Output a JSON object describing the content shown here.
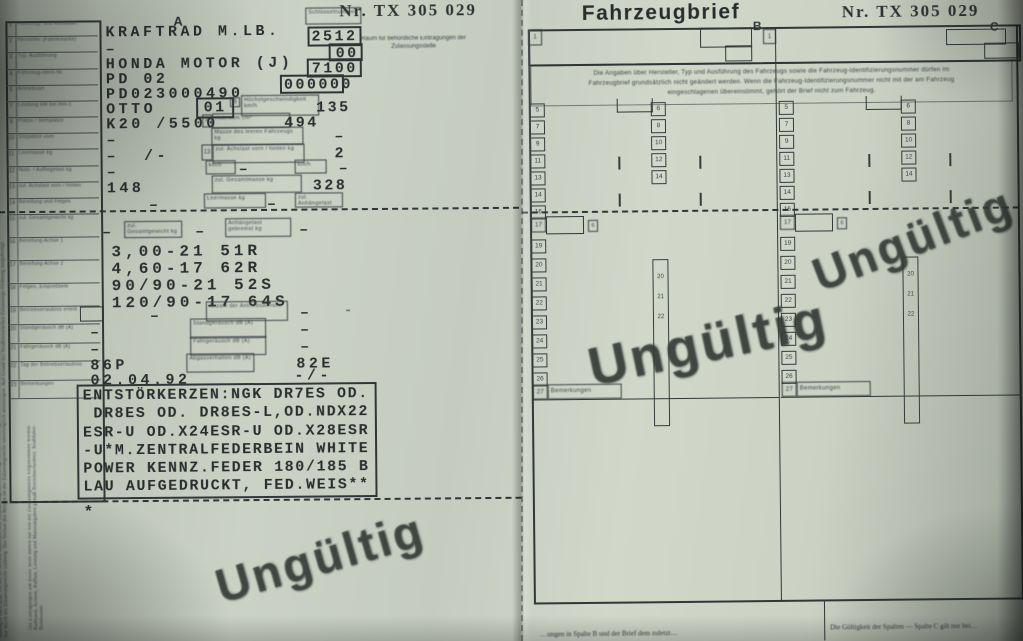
{
  "doc": {
    "serial": "Nr. TX 305 029",
    "stamp": "Ungültig"
  },
  "colors": {
    "paper": "#cbd2c5",
    "ink": "#2b2f30",
    "stamp_ink": "#363c38"
  },
  "left_page": {
    "section_label": "A",
    "header_note": "Raum für behördliche Eintragungen der Zulassungsstelle",
    "key_numbers": {
      "type": "2512",
      "check": "00",
      "manufacturer": "7100",
      "variant": "000000",
      "engine": "01",
      "engine_sup": "6",
      "cell8": "8",
      "cell13": "13",
      "cell9": "9"
    },
    "values": {
      "vehicle_kind": "KRAFTRAD M.LB.",
      "dash_a": "–",
      "manufacturer": "HONDA MOTOR (J)",
      "type": "PD 02",
      "vin": "PD023000490",
      "engine_type": "OTTO",
      "power_rpm": "K20 /5500",
      "dash_b": "–",
      "dash_c": "–  /-",
      "dash_d": "–",
      "curb_mass": "148"
    },
    "right_values": {
      "top_speed": "135",
      "displacement": "494",
      "dash_a": "–",
      "axles": "2",
      "dash_b": "–",
      "dash_c": "–",
      "total_mass": "328",
      "dash_d": "–",
      "dash_e": "–"
    },
    "row_above_tires": {
      "dash_l": "–",
      "dash_m": "–",
      "dash_r": "–"
    },
    "tires": [
      "3,00-21 51R",
      "4,60-17 62R",
      "90/90-21 52S",
      "120/90-17 64S"
    ],
    "lower_rows": {
      "dash1_l": "–",
      "dash1_r": "–",
      "tail_dash": "-",
      "dash2_l": "–",
      "dash2_r": "–",
      "dash3_l": "–",
      "dash3_r": "–",
      "stand_noise": "86P",
      "drive_noise": "82E",
      "date": "02.04.92",
      "date_right": "-/-"
    },
    "remarks_lines": [
      "ENTSTÖRKERZEN:NGK DR7ES OD.",
      " DR8ES OD. DR8ES-L,OD.NDX22",
      "ESR-U OD.X24ESR-U OD.X28ESR",
      "-U*M.ZENTRALFEDERBEIN WHITE",
      "POWER KENNZ.FEDER 180/185 B",
      "LAU AUFGEDRUCKT, FED.WEIS**"
    ],
    "footnote_star": "*",
    "micro_labels": [
      "Schlüsselnummer",
      "Höchstgeschwindigkeit km/h",
      "Hubraum cm³",
      "Masse des leeren Fahrzeugs kg",
      "zul. Achslast vorn / hinten kg",
      "km/h",
      "km/h",
      "zul. Gesamtmasse kg",
      "Leermasse kg",
      "zul. Anhängelast kg",
      "zul. Gesamtgewicht kg",
      "Anhängelast gebremst kg",
      "Anzahl der Antriebsachsen",
      "Standgeräusch dB (A)",
      "Fahrgeräusch dB (A)",
      "Abgasverhalten dB (A)"
    ],
    "label_rows_top": [
      {
        "n": "1",
        "t": "Fahrzeug- und Aufbauart"
      },
      {
        "n": "2",
        "t": "Hersteller (Fabrikmarke)"
      },
      {
        "n": "3",
        "t": "Typ, Ausführung"
      },
      {
        "n": "4",
        "t": "Fahrzeug-Ident-Nr."
      },
      {
        "n": "5",
        "t": "Antriebsart"
      },
      {
        "n": "7",
        "t": "Leistung kW bei min-1"
      },
      {
        "n": "9",
        "t": "Plätze / Stehplätze"
      },
      {
        "n": "10",
        "t": "Sitzplätze vorn"
      },
      {
        "n": "11",
        "t": "Leermasse kg"
      },
      {
        "n": "12",
        "t": "Nutz- / Aufliegelast kg"
      },
      {
        "n": "13",
        "t": "zul. Achslast vorn / hinten"
      },
      {
        "n": "14",
        "t": "Bereifung und Felgen"
      }
    ],
    "label_rows_mid": [
      {
        "n": "15",
        "t": "zul. Gesamtgewicht kg"
      },
      {
        "n": "16",
        "t": "Bereifung Achse 1"
      },
      {
        "n": "17",
        "t": "Bereifung Achse 2"
      },
      {
        "n": "18",
        "t": "Felgen, Einpreßtiefe"
      }
    ],
    "label_rows_low": [
      {
        "n": "19",
        "t": "Betriebserlaubnis erteilt"
      },
      {
        "n": "20",
        "t": "Standgeräusch dB (A)"
      },
      {
        "n": "21",
        "t": "Fahrgeräusch dB (A)"
      },
      {
        "n": "22",
        "t": "Tag der Betriebserlaubnis"
      },
      {
        "n": "23",
        "t": "Bemerkungen"
      }
    ],
    "margin_text": "Auflagen nach §§ 19, 20, 21 StVZO beachten. Bei Veräußerung des Fahrzeugs ist der Fahrzeugbrief dem Erwerber auszuhändigen. Änderungen der eingetragenen Angaben sind nur durch die Zulassungsstelle zulässig. Der Verlust des Briefes ist der Zulassungsstelle unverzüglich anzuzeigen. Auf Grund der Straßenverkehrs-Zulassungs-Ordnung ausgefertigt.",
    "margin_text2": "Die Eintragungen auf dieser Seite dürfen nur von der Zulassungsstelle vorgenommen werden. Radstand, Achsen, Aufbau, Leistung und Masseangaben gemäß Betriebserlaubnis. Kraftfahrt-Bundesamt."
  },
  "right_page": {
    "title": "Fahrzeugbrief",
    "section_b": "B",
    "section_c": "C",
    "row_number_1": "1",
    "intro_lines": [
      "Die Angaben über Hersteller, Typ und Ausführung des Fahrzeugs sowie die Fahrzeug-Identifizierungsnummer dürfen im",
      "Fahrzeugbrief grundsätzlich nicht geändert werden. Wenn die Fahrzeug-Identifizierungsnummer nicht mit der am Fahrzeug",
      "eingeschlagenen übereinstimmt, gehört der Brief nicht zum Fahrzeug."
    ],
    "col_top_nums": [
      "5",
      "7",
      "9",
      "11",
      "13",
      "14",
      "16"
    ],
    "col_mid_nums": [
      "6",
      "8",
      "10",
      "12",
      "14"
    ],
    "col_low_nums": [
      "19",
      "20",
      "21",
      "22",
      "23",
      "24",
      "25",
      "26"
    ],
    "strip_nums": [
      "20",
      "21",
      "22"
    ],
    "row_17": "17",
    "aux_cell": "6",
    "bem_row_num": "27",
    "bemerkungen": "Bemerkungen",
    "footer_left": "…ungen in Spalte B und der Brief dem zuletzt…",
    "footer_right": "Die Gültigkeit der Spalten — Spalte C gilt nur bei…"
  }
}
